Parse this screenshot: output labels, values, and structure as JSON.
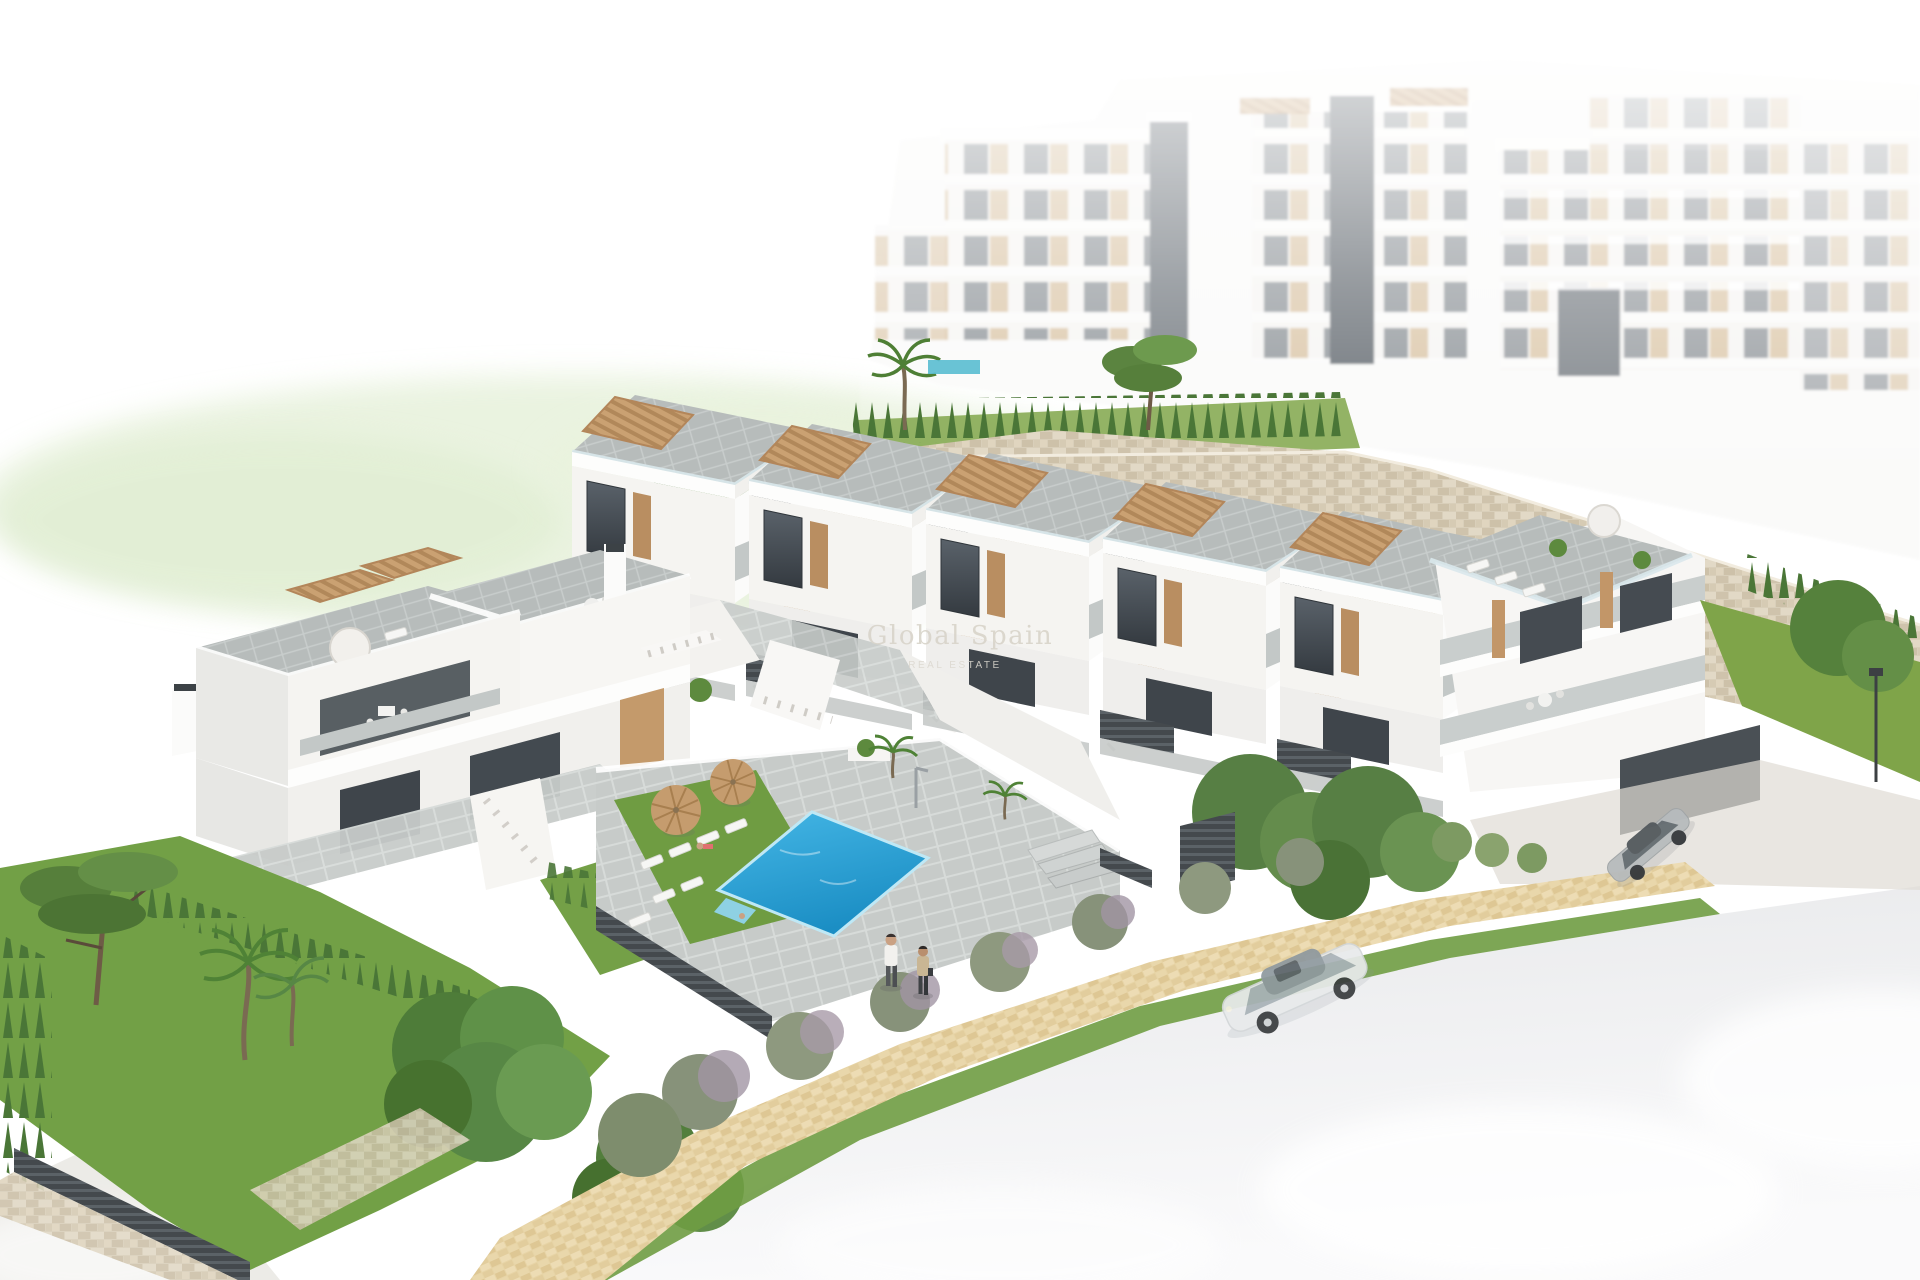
{
  "scene": {
    "type": "3d-architectural-render",
    "subject": "Aerial 3D render of a modern white Mediterranean residential development: stepped row of townhouses with roof terraces and pergolas, large apartment blocks on an upper terrace behind a stone retaining wall, communal swimming pool with sun loungers and parasols, landscaped gardens, beige pedestrian walkway and a pale street with parked cars",
    "background": "#ffffff"
  },
  "watermark": {
    "brand": "Global Spain",
    "tagline": "REAL ESTATE"
  },
  "colors": {
    "pool_water": "#2fa5d9",
    "pool_water_deep": "#1b8ec4",
    "lawn_green": "#6f9c42",
    "hedge_green": "#4a7637",
    "stone_wall": "#d9cfba",
    "wood_accent": "#c49a6b",
    "terrace_tile": "#b7bcbb",
    "dark_fence": "#44494d",
    "window_glass": "#474e54",
    "path_paving": "#e7d4a6",
    "road_surface": "#ececee",
    "hill_wash": "#e3efd6",
    "watermark_tint": "#d9d5cb"
  },
  "objects": {
    "apartment_blocks": "white multi-storey apartment buildings with beige balcony recesses on the upper level",
    "townhouse_row": "stepped row of white two-storey townhouses with external stairs, roof terraces and timber pergolas",
    "left_building": "two-storey corner apartment building with roof terraces, parasol and dining sets",
    "end_building": "larger apartment building with open terraces and garage at the right end of the row",
    "pool": "communal swimming pool with lawn, white sun loungers, two wicker parasols and outdoor shower",
    "walkway": "beige paved pedestrian walkway between gardens and street",
    "cars": [
      "white sedan parked on the street",
      "grey coupe parked in the driveway"
    ],
    "people": [
      "man in white shirt walking on the path",
      "woman in beige top walking on the path",
      "sunbather on a lounger",
      "child at the pool steps"
    ]
  }
}
